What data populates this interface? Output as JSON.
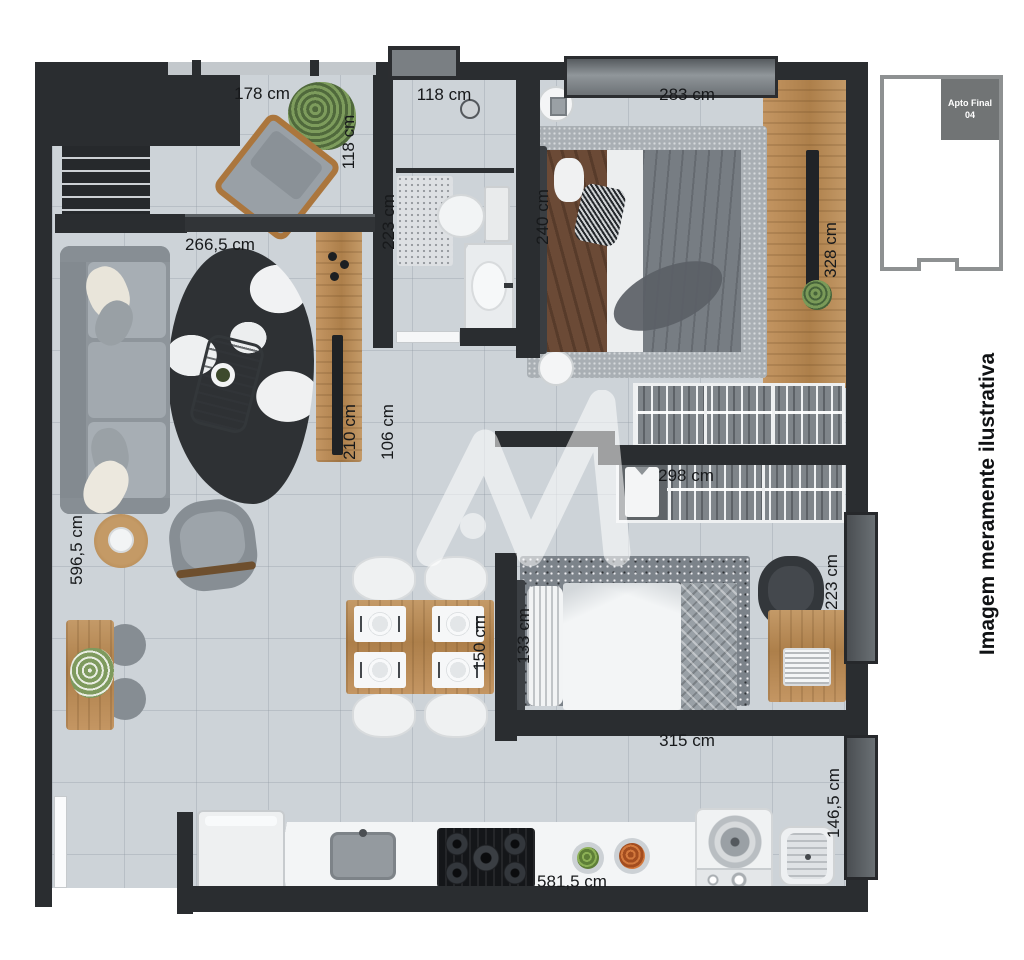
{
  "plan": {
    "disclaimer": "Imagem meramente ilustrativa",
    "key_plan": {
      "unit_label": "Apto Final 04"
    },
    "watermark_icon": "m-logo",
    "dims": {
      "balcony_width": "178 cm",
      "balcony_depth": "118 cm",
      "bathroom_width": "118 cm",
      "bathroom_depth": "223 cm",
      "master_width": "283 cm",
      "master_depth": "240 cm",
      "master_closet_side": "328 cm",
      "living_width": "266,5 cm",
      "living_depth": "596,5 cm",
      "tv_console_length": "210 cm",
      "hall_width": "106 cm",
      "closet_width": "298 cm",
      "bedroom2_bed_width": "133 cm",
      "dining_width": "150 cm",
      "bedroom2_width": "315 cm",
      "bedroom2_depth": "223 cm",
      "kitchen_length": "581,5 cm",
      "service_depth": "146,5 cm"
    }
  }
}
